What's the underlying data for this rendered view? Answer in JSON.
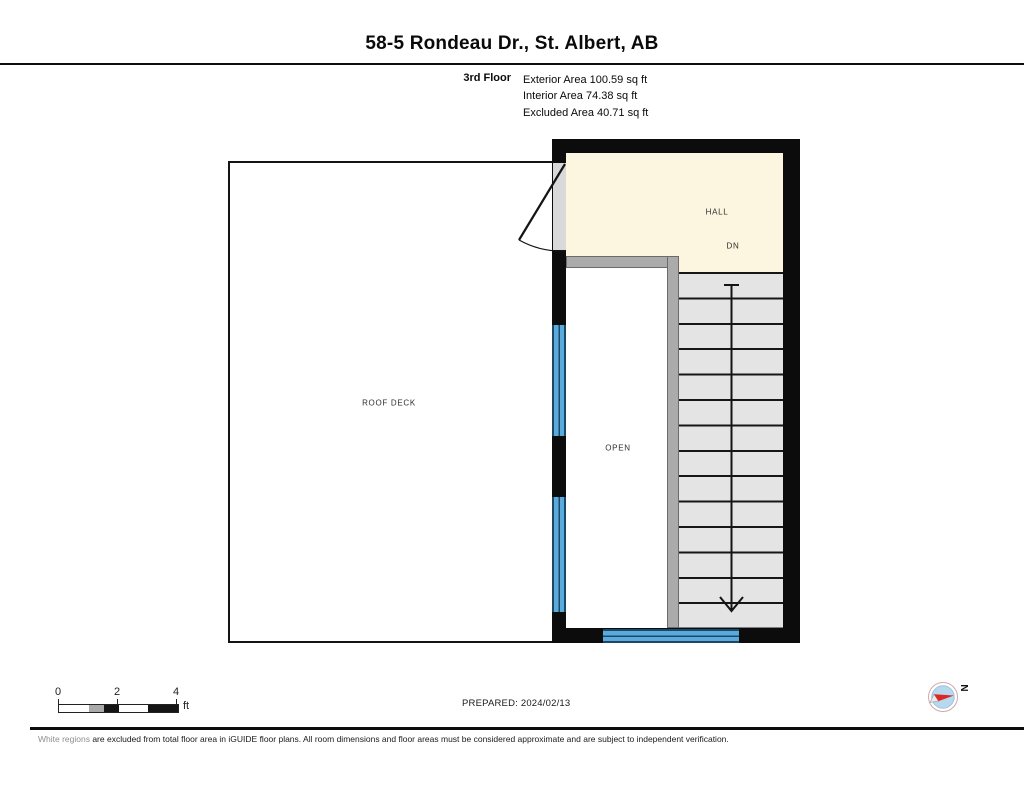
{
  "header": {
    "title": "58-5 Rondeau Dr., St. Albert, AB"
  },
  "floor_info": {
    "floor_label": "3rd Floor",
    "stats": {
      "exterior": "Exterior Area 100.59 sq ft",
      "interior": "Interior Area 74.38 sq ft",
      "excluded": "Excluded Area 40.71 sq ft"
    }
  },
  "plan": {
    "roof_deck_label": "ROOF DECK",
    "hall_label": "HALL",
    "down_label": "DN",
    "open_label": "OPEN"
  },
  "footer": {
    "scale": {
      "tick_0": "0",
      "tick_2": "2",
      "tick_4": "4",
      "unit": "ft"
    },
    "prepared": "PREPARED: 2024/02/13",
    "compass_north_label": "N",
    "disclaimer_lead": "White regions",
    "disclaimer_rest": " are excluded from total floor area in iGUIDE floor plans. All room dimensions and floor areas must be considered approximate and are subject to independent verification."
  },
  "colors": {
    "wall_black": "#0c0c0c",
    "hall_fill": "#fcf5df",
    "stair_fill": "#e4e4e4",
    "interior_wall_gray": "#ababab",
    "window_blue": "#5aabdc",
    "window_dark": "#1c4867",
    "compass_needle_red": "#e02525",
    "compass_inner_blue": "#b7d9ee"
  }
}
